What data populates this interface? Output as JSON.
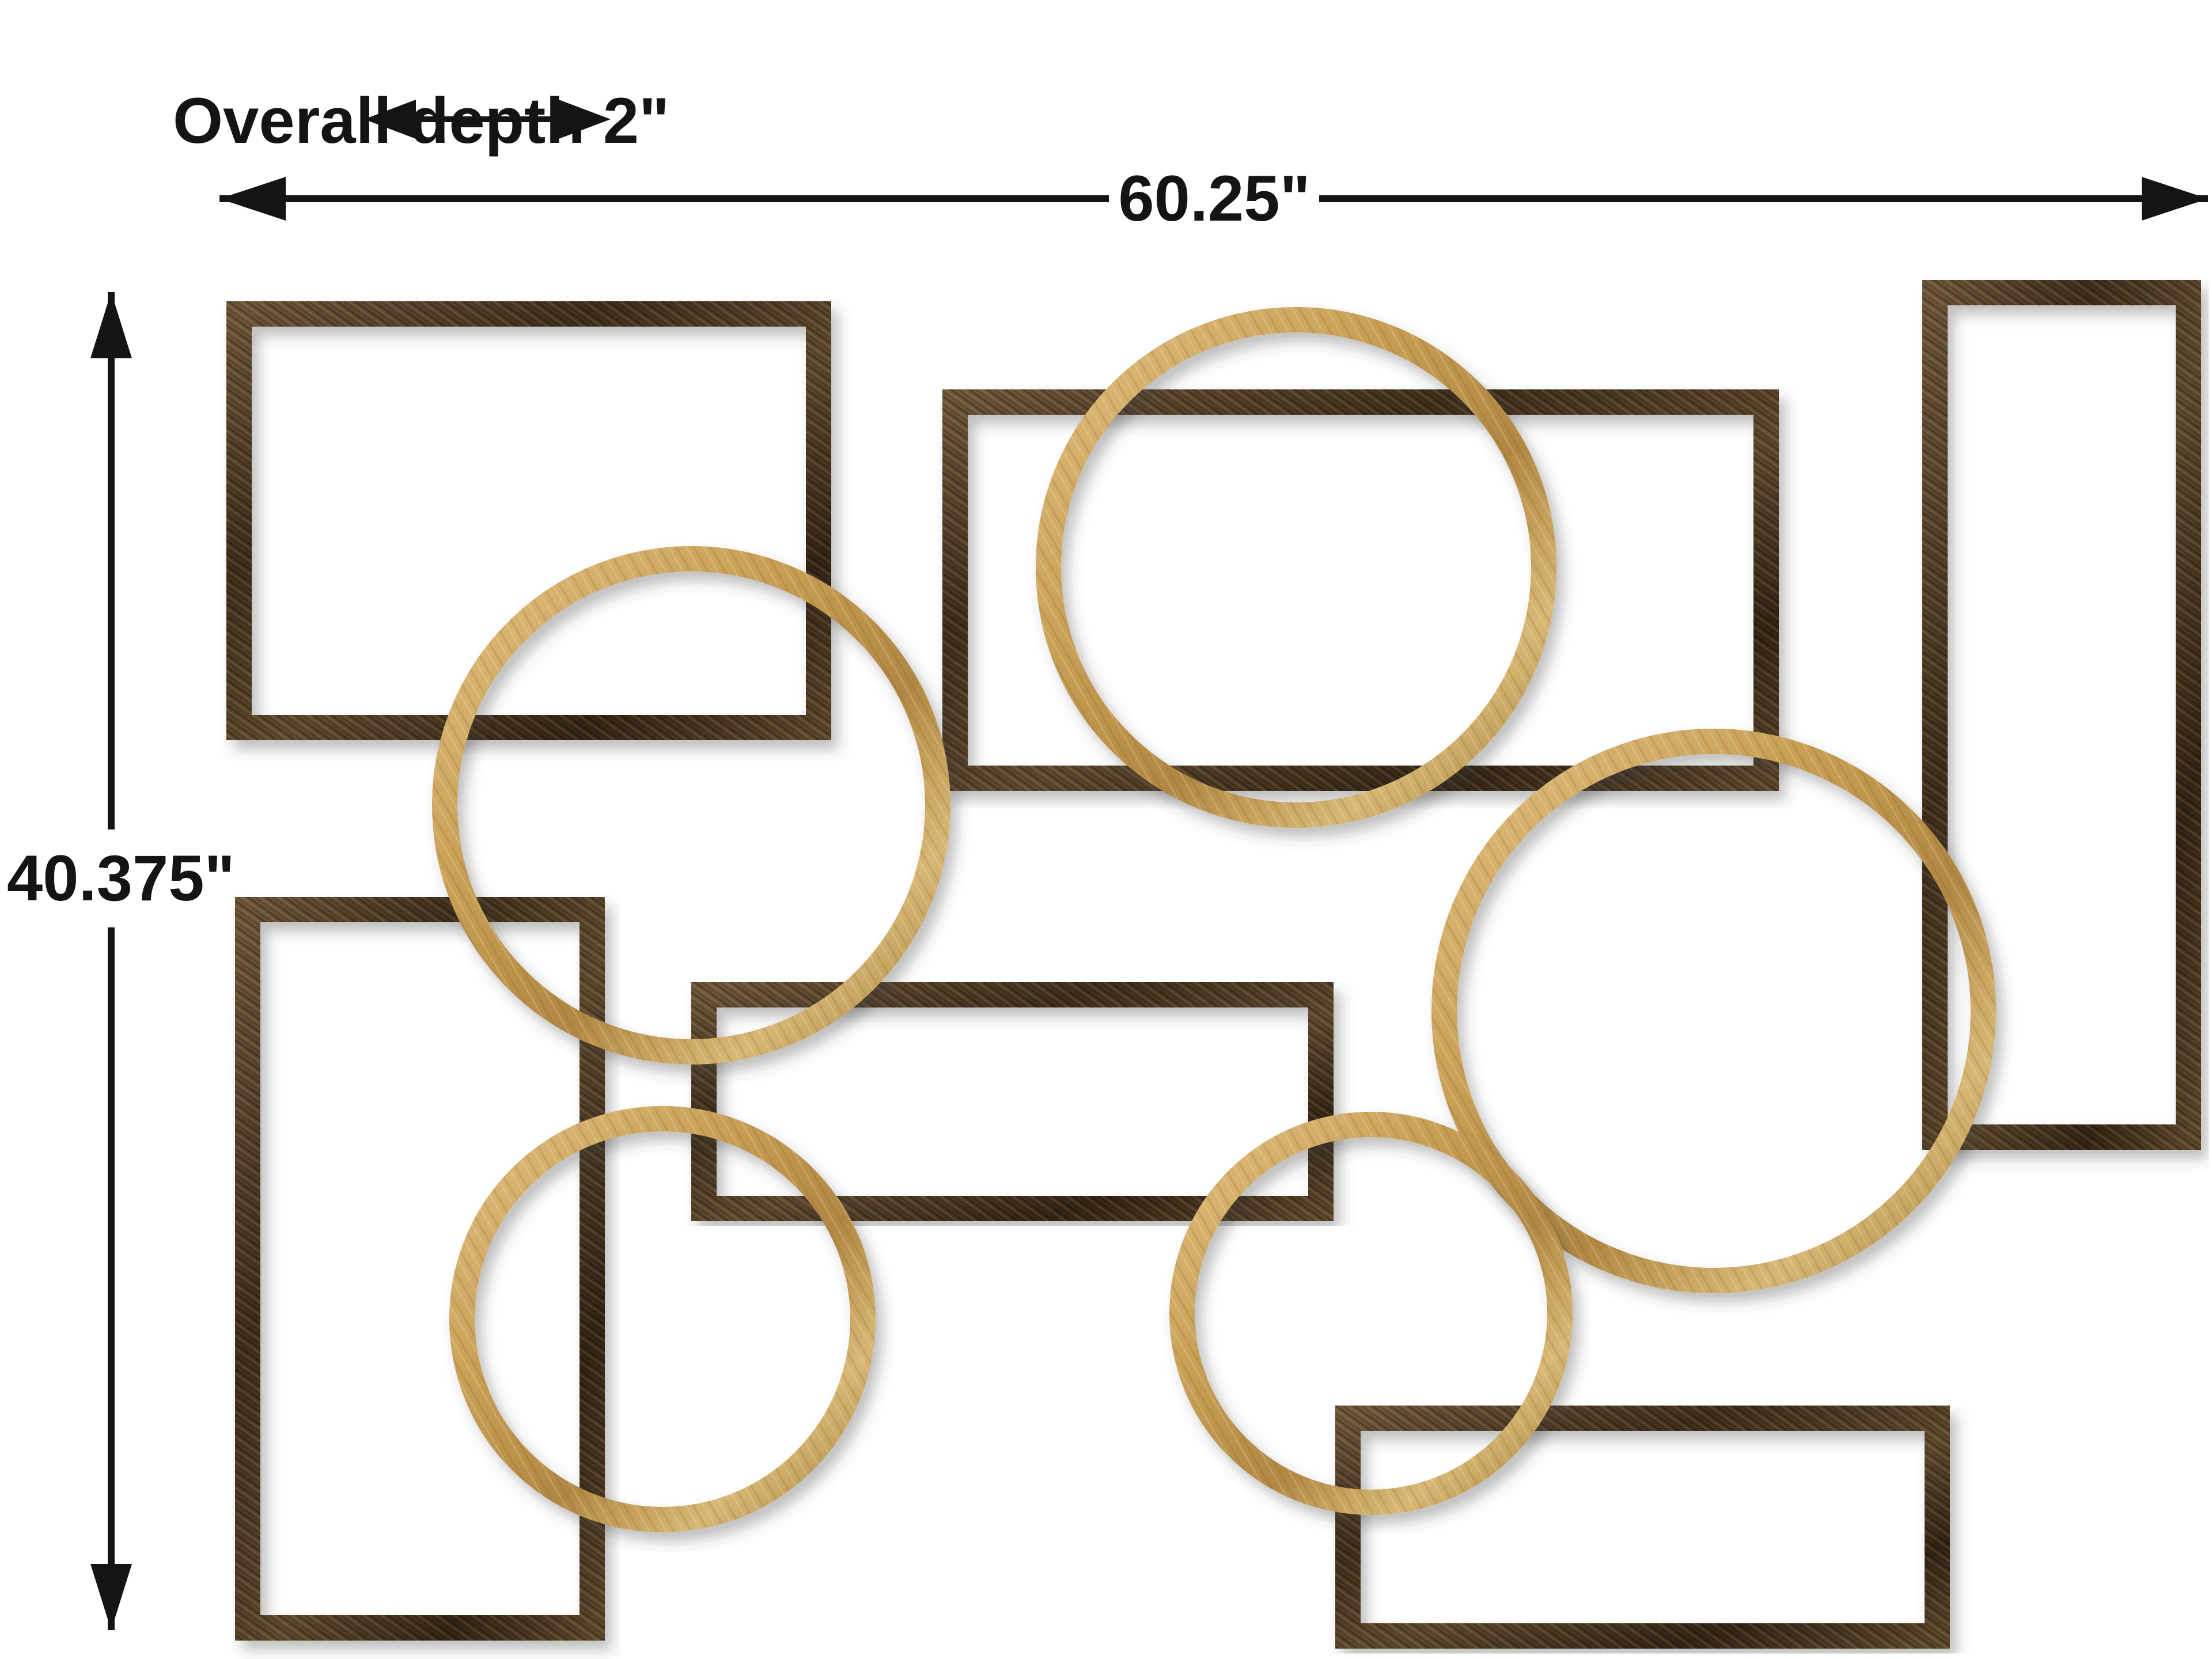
{
  "diagram": {
    "type": "product-dimension-diagram",
    "product": "abstract metal wall art of overlapping rectangles and circles",
    "background_color": "#ffffff",
    "labels": {
      "depth": "Overall depth 2\"",
      "width": "60.25\"",
      "height": "40.375\""
    },
    "colors": {
      "dimension_line": "#141414",
      "bronze_frame_dark": "#3a2b1a",
      "bronze_frame_light": "#6d5539",
      "gold_ring_dark": "#a67f3b",
      "gold_ring_light": "#e2c183"
    },
    "shapes": {
      "bronze_rectangles": [
        "top-left",
        "top-center",
        "right-tall",
        "middle",
        "bottom-left-tall",
        "bottom-right"
      ],
      "gold_circles": [
        "top-center",
        "mid-left",
        "right-large",
        "bottom-left",
        "bottom-center"
      ]
    }
  }
}
